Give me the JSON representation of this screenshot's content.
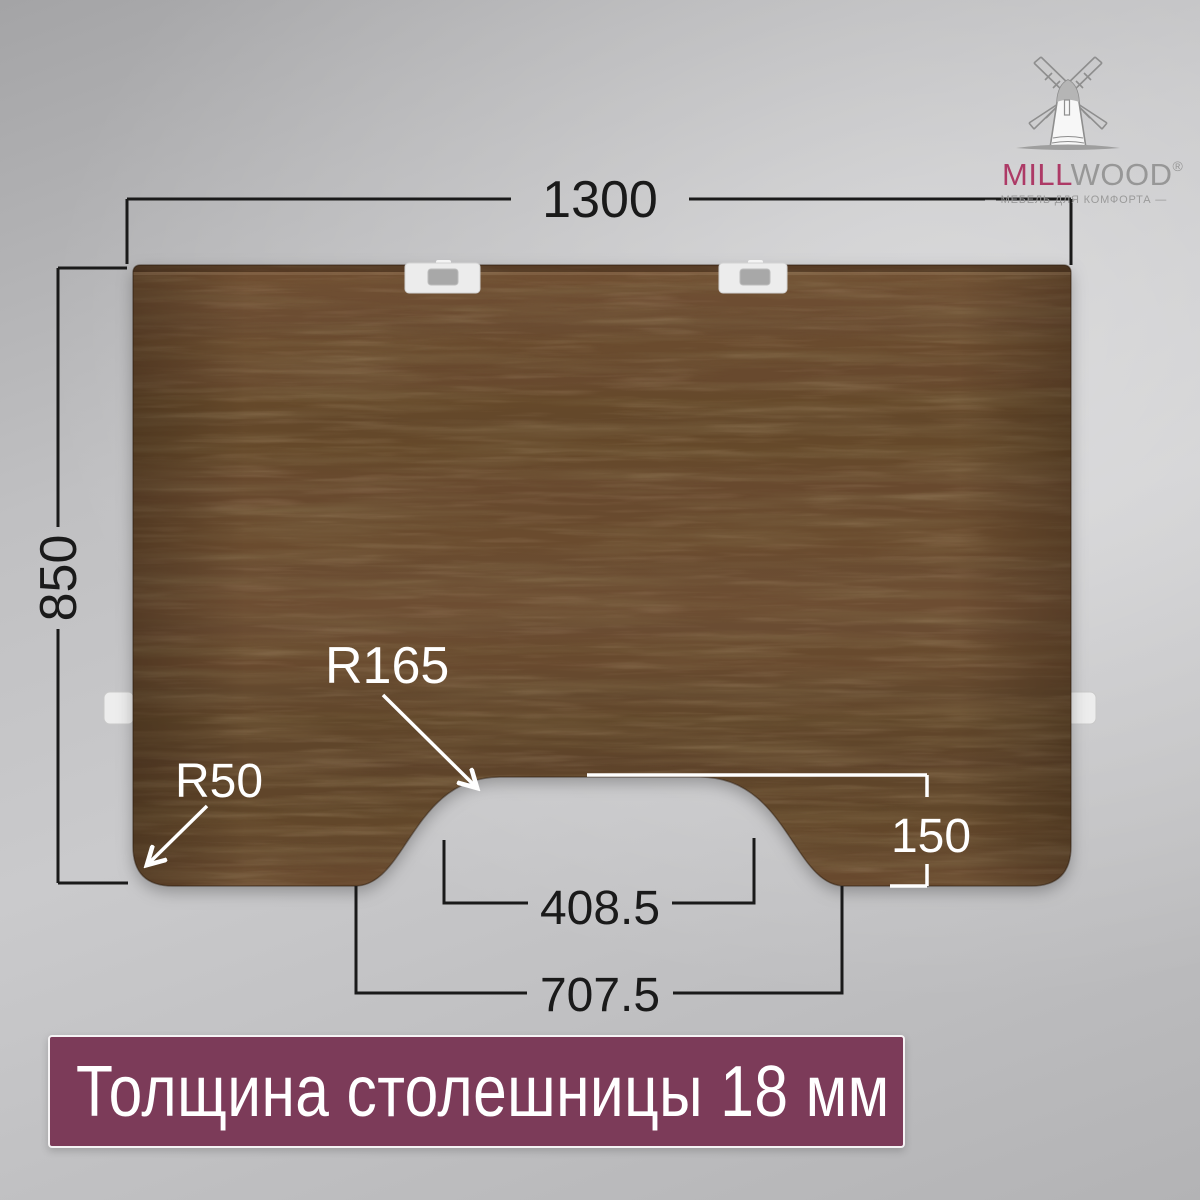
{
  "page": {
    "background_color": "#c1c1c3"
  },
  "brand_logo": {
    "wordmark_primary": "MILL",
    "wordmark_secondary": "WOOD",
    "registered_mark": "®",
    "tagline": "— МЕБЕЛЬ ДЛЯ КОМФОРТА —",
    "colors": {
      "primary": "#ad3a66",
      "gray": "#8d8d8d"
    }
  },
  "tabletop": {
    "material_color": "#654728",
    "dimensions": {
      "width_mm": "1300",
      "depth_mm": "850",
      "cutout_radius": "R165",
      "corner_radius": "R50",
      "cutout_depth_mm": "150",
      "cutout_inner_width_mm": "408.5",
      "cutout_outer_width_mm": "707.5"
    }
  },
  "banner": {
    "text": "Толщина столешницы 18 мм",
    "background_color": "#7c3b59",
    "text_color": "#ffffff"
  }
}
